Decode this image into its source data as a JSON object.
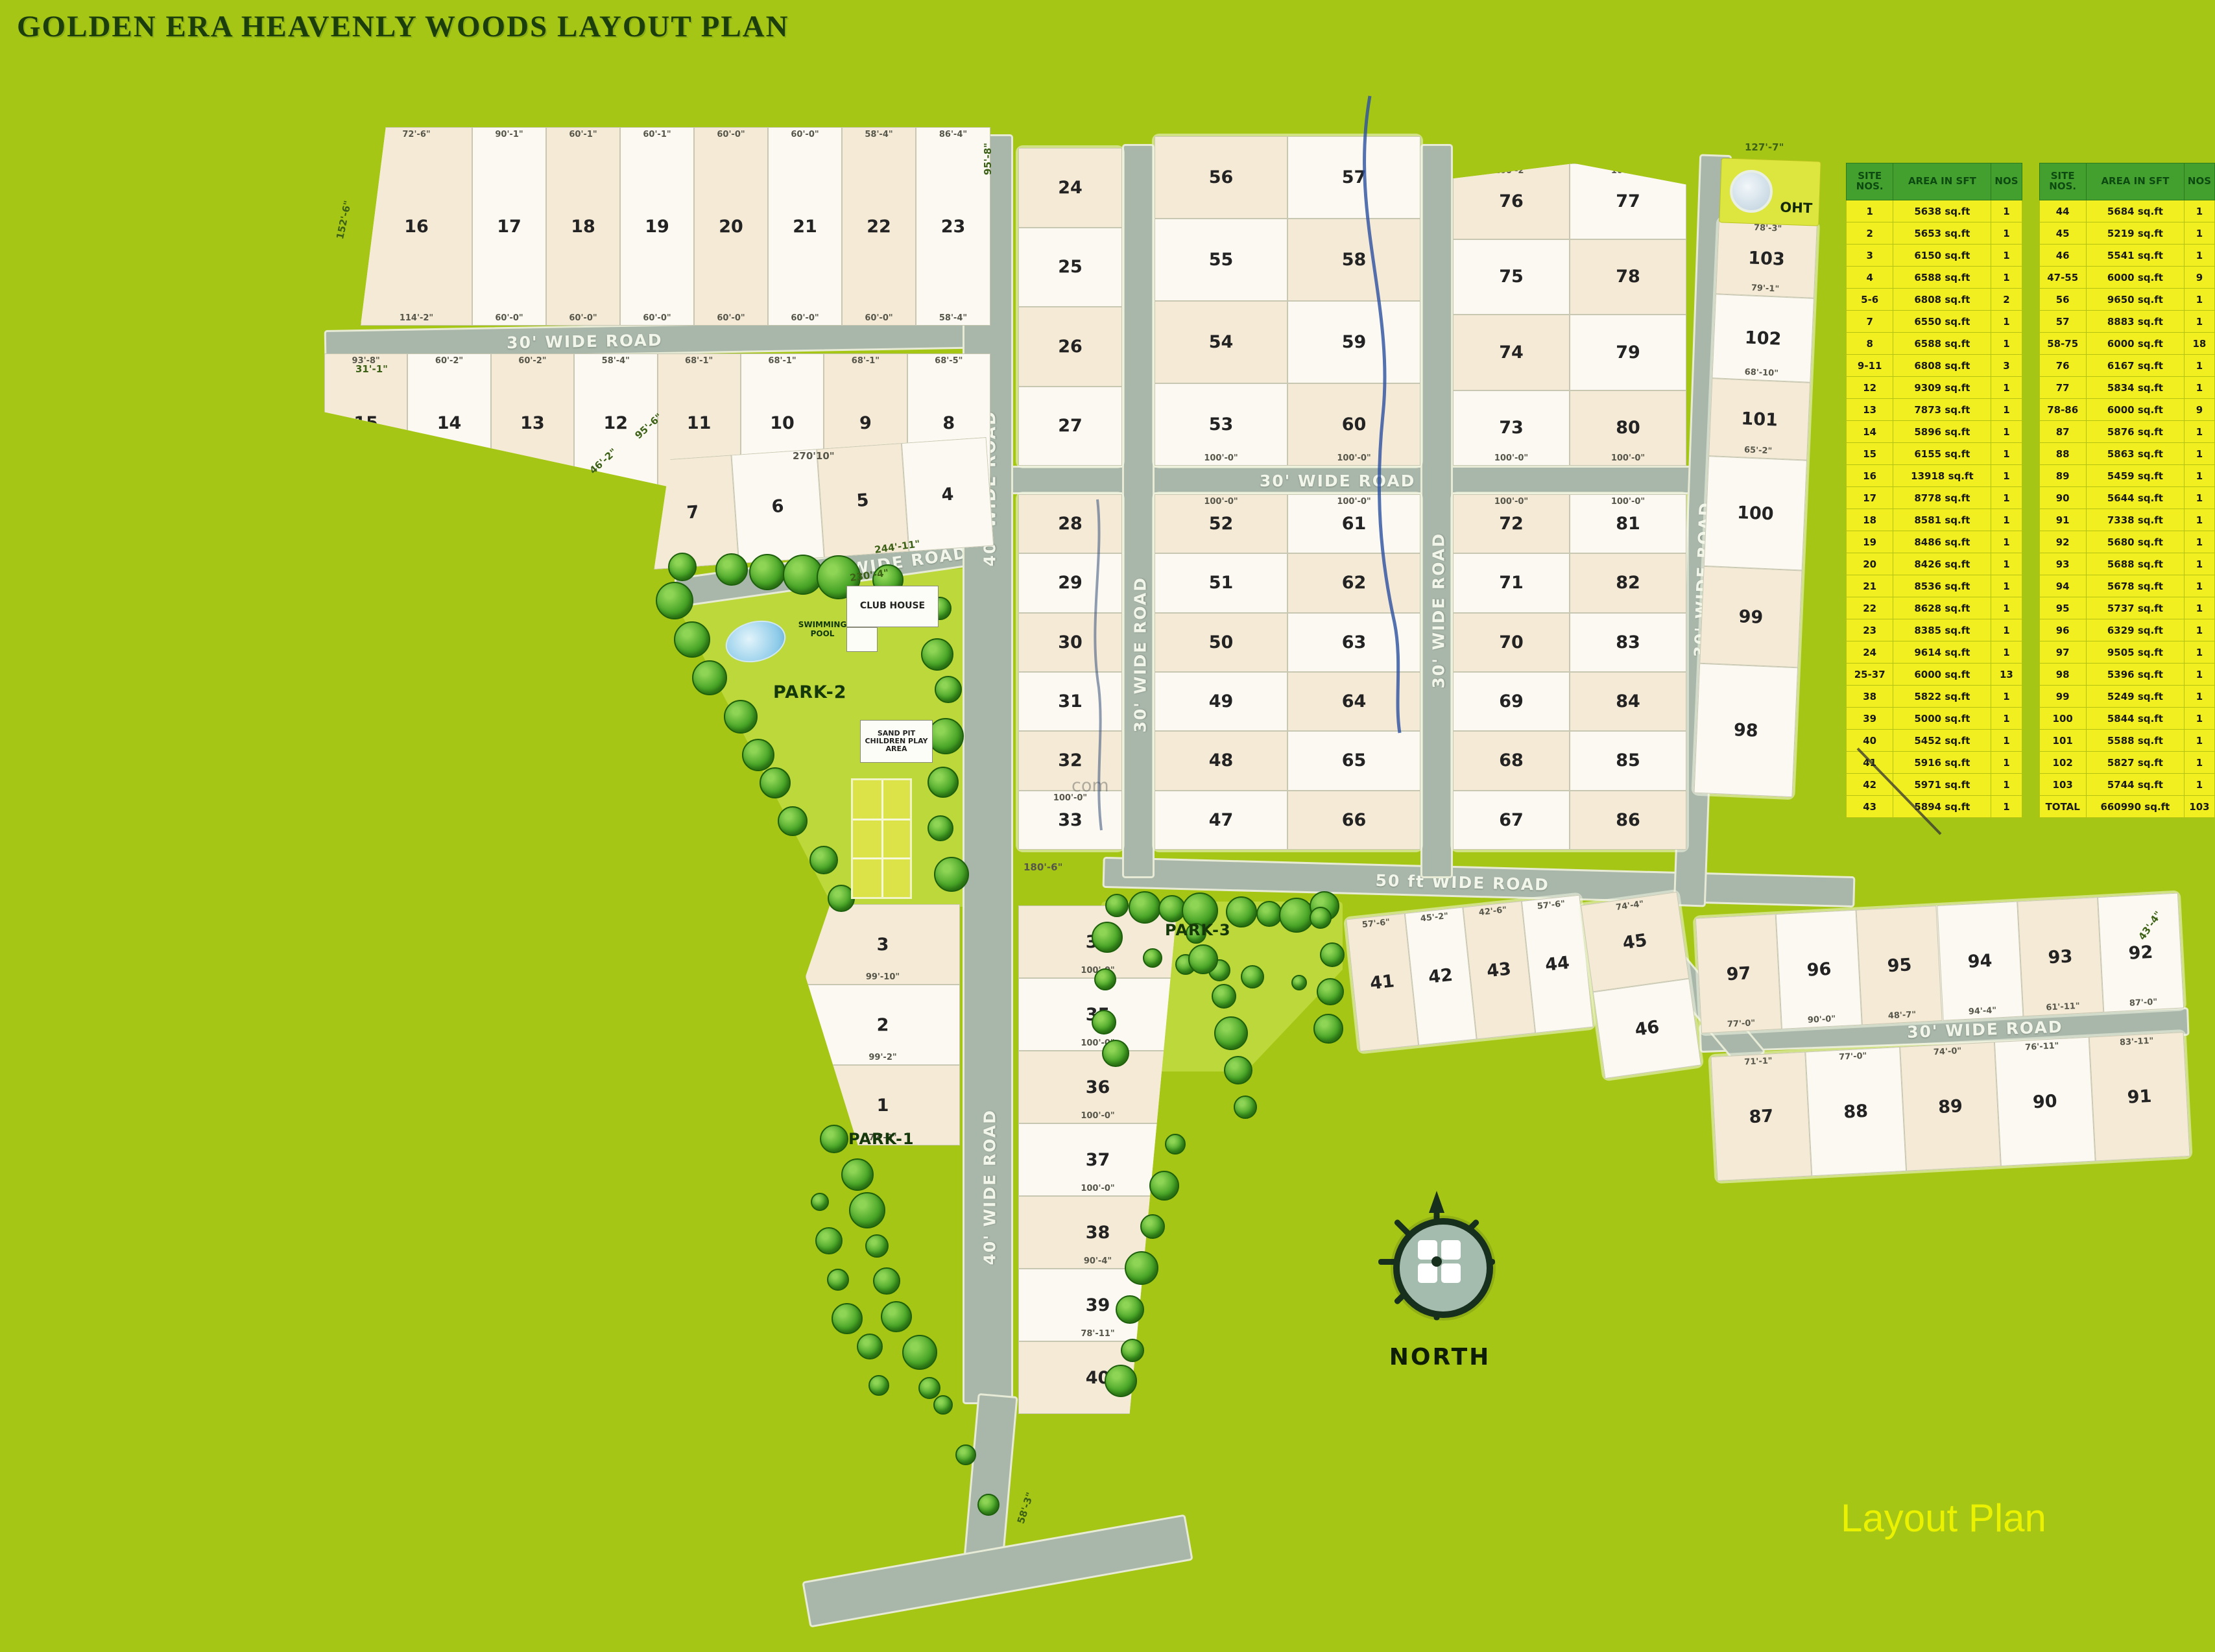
{
  "title": "GOLDEN ERA HEAVENLY WOODS LAYOUT PLAN",
  "corner_label": "Layout Plan",
  "compass_label": "NORTH",
  "watermark": "com",
  "colors": {
    "background": "#a6c615",
    "road_gray": "#a9b6aa",
    "plot_cream": "#f5ead6",
    "plot_light": "#fbf9f1",
    "park_green": "#bdd83b",
    "tree_green": "#4aa628",
    "legend_yellow": "#f2ef20",
    "legend_header_green": "#43a02e",
    "title_green": "#1b3e0c",
    "corner_yellow": "#ebf201",
    "stream_blue": "#2b4fa0"
  },
  "road_labels": {
    "thirty": "30' WIDE ROAD",
    "forty": "40' WIDE ROAD",
    "fifty": "50 ft WIDE ROAD"
  },
  "parks": {
    "park1": "PARK-1",
    "park2": "PARK-2",
    "park3": "PARK-3"
  },
  "amenities": {
    "club_house": "CLUB HOUSE",
    "swimming_pool": "SWIMMING POOL",
    "sand_pit": "SAND PIT CHILDREN PLAY AREA",
    "oht": "OHT"
  },
  "oht_dims": {
    "top": "127'-7\""
  },
  "free_dims": {
    "d244": "244'-11\"",
    "d230": "230'-4\"",
    "d270": "270'10\"",
    "d180": "180'-6\""
  },
  "boundary_dims": [
    "152'-6\"",
    "31'-1\"",
    "95'-6\"",
    "46'-2\"",
    "43'-4\"",
    "95'-8\"",
    "58'-3\""
  ],
  "plot_groups": {
    "row16_23": {
      "plots": [
        "16",
        "17",
        "18",
        "19",
        "20",
        "21",
        "22",
        "23"
      ],
      "top_dims": [
        "72'-6\"",
        "90'-1\"",
        "60'-1\"",
        "60'-1\"",
        "60'-0\"",
        "60'-0\"",
        "58'-4\"",
        "86'-4\""
      ],
      "bottom_dims": [
        "114'-2\"",
        "60'-0\"",
        "60'-0\"",
        "60'-0\"",
        "60'-0\"",
        "60'-0\"",
        "60'-0\"",
        "58'-4\""
      ]
    },
    "row15_8": {
      "plots": [
        "15",
        "14",
        "13",
        "12",
        "11",
        "10",
        "9",
        "8"
      ],
      "top_dims": [
        "93'-8\"",
        "60'-2\"",
        "60'-2\"",
        "58'-4\"",
        "68'-1\"",
        "68'-1\"",
        "68'-1\"",
        "68'-5\""
      ]
    },
    "row7_4": {
      "plots": [
        "7",
        "6",
        "5",
        "4"
      ]
    },
    "colA_top": {
      "plots": [
        "24",
        "25",
        "26",
        "27"
      ]
    },
    "colA_bottom": {
      "plots": [
        "28",
        "29",
        "30",
        "31",
        "32",
        "33"
      ],
      "top_dims": [
        "",
        "",
        "",
        "",
        "",
        "100'-0\""
      ]
    },
    "blockB_top": {
      "col1": [
        "56",
        "55",
        "54",
        "53"
      ],
      "col2": [
        "57",
        "58",
        "59",
        "60"
      ],
      "col1_cap_bottom": "100'-0\"",
      "col2_cap_bottom": "100'-0\""
    },
    "blockB_bottom": {
      "col1": [
        "52",
        "51",
        "50",
        "49",
        "48",
        "47"
      ],
      "col2": [
        "61",
        "62",
        "63",
        "64",
        "65",
        "66"
      ],
      "col1_cap_top": "100'-0\"",
      "col2_cap_top": "100'-0\""
    },
    "blockC_top": {
      "col1": [
        "76",
        "75",
        "74",
        "73"
      ],
      "col2": [
        "77",
        "78",
        "79",
        "80"
      ],
      "col1_cap_top": "100'-2\"",
      "col2_cap_top": "100'-1\"",
      "col1_cap_bottom": "100'-0\"",
      "col2_cap_bottom": "100'-0\""
    },
    "blockC_bottom": {
      "col1": [
        "72",
        "71",
        "70",
        "69",
        "68",
        "67"
      ],
      "col2": [
        "81",
        "82",
        "83",
        "84",
        "85",
        "86"
      ],
      "col1_cap_top": "100'-0\"",
      "col2_cap_top": "100'-0\""
    },
    "colR": {
      "plots": [
        {
          "n": "103",
          "top": "78'-3\"",
          "bottom": "79'-1\""
        },
        {
          "n": "102",
          "bottom": "68'-10\""
        },
        {
          "n": "101",
          "bottom": "65'-2\""
        },
        {
          "n": "100"
        },
        {
          "n": "99"
        },
        {
          "n": "98"
        }
      ]
    },
    "block1_3": {
      "plots": [
        "3",
        "2",
        "1"
      ],
      "bottom_dims": [
        "99'-10\"",
        "99'-2\"",
        "77'-0\""
      ]
    },
    "block34_40": {
      "plots": [
        "34",
        "35",
        "36",
        "37",
        "38",
        "39",
        "40"
      ],
      "bottom_dims": [
        "100'-0\"",
        "100'-0\"",
        "100'-0\"",
        "100'-0\"",
        "90'-4\"",
        "78'-11\"",
        ""
      ]
    },
    "block41_44": {
      "plots": [
        "41",
        "42",
        "43",
        "44"
      ],
      "top_dims": [
        "57'-6\"",
        "45'-2\"",
        "42'-6\"",
        "57'-6\""
      ]
    },
    "block45_46": {
      "plots": [
        "45",
        "46"
      ],
      "top_dims": [
        "74'-4\"",
        ""
      ]
    },
    "block92_97": {
      "plots": [
        "97",
        "96",
        "95",
        "94",
        "93",
        "92"
      ],
      "bottom_dims": [
        "77'-0\"",
        "90'-0\"",
        "48'-7\"",
        "94'-4\"",
        "61'-11\"",
        "87'-0\""
      ]
    },
    "block87_91": {
      "plots": [
        "87",
        "88",
        "89",
        "90",
        "91"
      ],
      "top_dims": [
        "71'-1\"",
        "77'-0\"",
        "74'-0\"",
        "76'-11\"",
        "83'-11\""
      ]
    }
  },
  "legend": {
    "headers": [
      "SITE NOS.",
      "AREA IN SFT",
      "NOS"
    ],
    "tables": [
      [
        [
          "1",
          "5638 sq.ft",
          "1"
        ],
        [
          "2",
          "5653 sq.ft",
          "1"
        ],
        [
          "3",
          "6150 sq.ft",
          "1"
        ],
        [
          "4",
          "6588 sq.ft",
          "1"
        ],
        [
          "5-6",
          "6808 sq.ft",
          "2"
        ],
        [
          "7",
          "6550 sq.ft",
          "1"
        ],
        [
          "8",
          "6588 sq.ft",
          "1"
        ],
        [
          "9-11",
          "6808 sq.ft",
          "3"
        ],
        [
          "12",
          "9309 sq.ft",
          "1"
        ],
        [
          "13",
          "7873 sq.ft",
          "1"
        ],
        [
          "14",
          "5896 sq.ft",
          "1"
        ],
        [
          "15",
          "6155 sq.ft",
          "1"
        ],
        [
          "16",
          "13918 sq.ft",
          "1"
        ],
        [
          "17",
          "8778 sq.ft",
          "1"
        ],
        [
          "18",
          "8581 sq.ft",
          "1"
        ],
        [
          "19",
          "8486 sq.ft",
          "1"
        ],
        [
          "20",
          "8426 sq.ft",
          "1"
        ],
        [
          "21",
          "8536 sq.ft",
          "1"
        ],
        [
          "22",
          "8628 sq.ft",
          "1"
        ],
        [
          "23",
          "8385 sq.ft",
          "1"
        ],
        [
          "24",
          "9614 sq.ft",
          "1"
        ],
        [
          "25-37",
          "6000 sq.ft",
          "13"
        ],
        [
          "38",
          "5822 sq.ft",
          "1"
        ],
        [
          "39",
          "5000 sq.ft",
          "1"
        ],
        [
          "40",
          "5452 sq.ft",
          "1"
        ],
        [
          "41",
          "5916 sq.ft",
          "1"
        ],
        [
          "42",
          "5971 sq.ft",
          "1"
        ],
        [
          "43",
          "5894 sq.ft",
          "1"
        ]
      ],
      [
        [
          "44",
          "5684 sq.ft",
          "1"
        ],
        [
          "45",
          "5219 sq.ft",
          "1"
        ],
        [
          "46",
          "5541 sq.ft",
          "1"
        ],
        [
          "47-55",
          "6000 sq.ft",
          "9"
        ],
        [
          "56",
          "9650 sq.ft",
          "1"
        ],
        [
          "57",
          "8883 sq.ft",
          "1"
        ],
        [
          "58-75",
          "6000 sq.ft",
          "18"
        ],
        [
          "76",
          "6167 sq.ft",
          "1"
        ],
        [
          "77",
          "5834 sq.ft",
          "1"
        ],
        [
          "78-86",
          "6000 sq.ft",
          "9"
        ],
        [
          "87",
          "5876 sq.ft",
          "1"
        ],
        [
          "88",
          "5863 sq.ft",
          "1"
        ],
        [
          "89",
          "5459 sq.ft",
          "1"
        ],
        [
          "90",
          "5644 sq.ft",
          "1"
        ],
        [
          "91",
          "7338 sq.ft",
          "1"
        ],
        [
          "92",
          "5680 sq.ft",
          "1"
        ],
        [
          "93",
          "5688 sq.ft",
          "1"
        ],
        [
          "94",
          "5678 sq.ft",
          "1"
        ],
        [
          "95",
          "5737 sq.ft",
          "1"
        ],
        [
          "96",
          "6329 sq.ft",
          "1"
        ],
        [
          "97",
          "9505 sq.ft",
          "1"
        ],
        [
          "98",
          "5396 sq.ft",
          "1"
        ],
        [
          "99",
          "5249 sq.ft",
          "1"
        ],
        [
          "100",
          "5844 sq.ft",
          "1"
        ],
        [
          "101",
          "5588 sq.ft",
          "1"
        ],
        [
          "102",
          "5827 sq.ft",
          "1"
        ],
        [
          "103",
          "5744 sq.ft",
          "1"
        ],
        [
          "TOTAL",
          "660990 sq.ft",
          "103"
        ]
      ]
    ]
  }
}
